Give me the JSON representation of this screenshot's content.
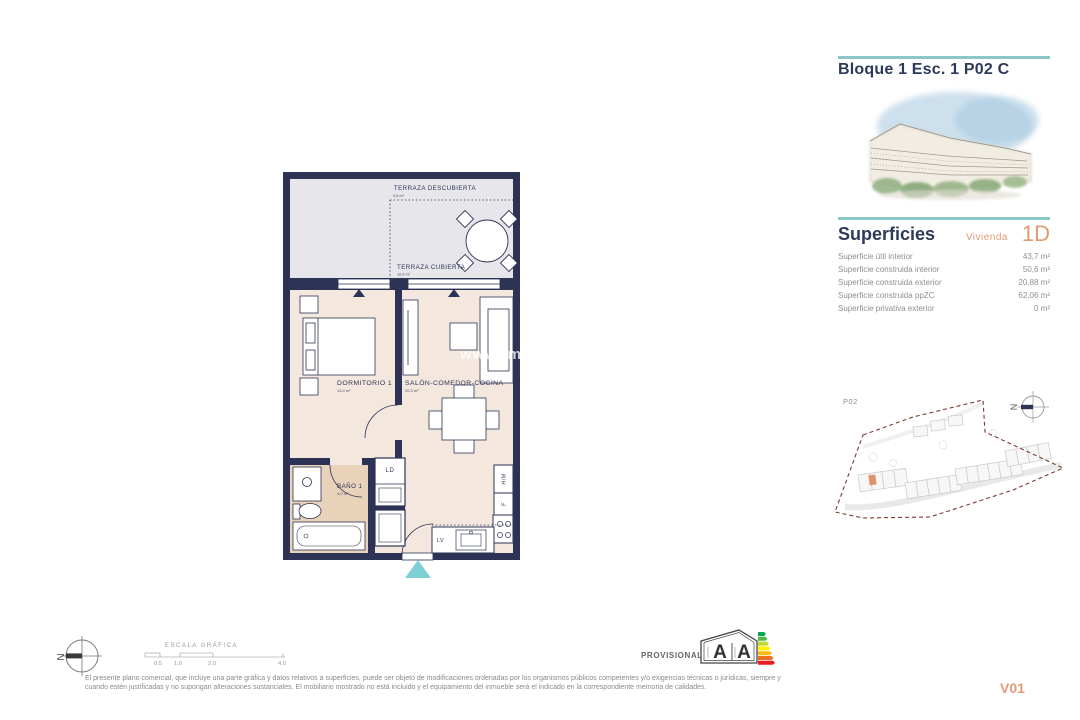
{
  "header": {
    "title": "Bloque 1 Esc. 1 P02 C"
  },
  "superficies": {
    "title": "Superficies",
    "unit_label": "Vivienda",
    "unit_value": "1D",
    "rows": [
      {
        "label": "Superficie útil interior",
        "value": "43,7 m²"
      },
      {
        "label": "Superficie construida interior",
        "value": "50,6 m²"
      },
      {
        "label": "Superficie construida exterior",
        "value": "20,88 m²"
      },
      {
        "label": "Superficie construida ppZC",
        "value": "62,06 m²"
      },
      {
        "label": "Superficie privativa exterior",
        "value": "0 m²"
      }
    ]
  },
  "site_plan": {
    "floor_label": "P02",
    "north_label": "N"
  },
  "floor_plan": {
    "watermark": "www.im",
    "terraza_descubierta": {
      "label": "TERRAZA DESCUBIERTA",
      "area": "9,9 m²"
    },
    "terraza_cubierta": {
      "label": "TERRAZA CUBIERTA",
      "area": "10,9 m²"
    },
    "dormitorio": {
      "label": "DORMITORIO 1",
      "area": "13,4 m²"
    },
    "salon": {
      "label": "SALÓN-COMEDOR-COCINA",
      "area": "20,3 m²"
    },
    "bano": {
      "label": "BAÑO 1",
      "area": "4,0 m²"
    },
    "ld_label": "LD",
    "hm_label": "H/M",
    "f_label": "F",
    "lv_label": "LV"
  },
  "footer": {
    "north_label": "N",
    "scale_title": "ESCALA GRÁFICA",
    "scale_ticks": [
      "0.5",
      "1.0",
      "2.0",
      "4.0"
    ],
    "provisional_label": "PROVISIONAL",
    "energy_letter_left": "A",
    "energy_letter_right": "A",
    "disclaimer_line1": "El presente plano comercial, que incluye una parte gráfica y datos relativos a superficies, puede ser objeto de modificaciones ordenadas por los organismos públicos competentes y/o exigencias técnicas o jurídicas, siempre y",
    "disclaimer_line2": "cuando estén justificadas y no supongan alteraciones sustanciales. El mobiliario mostrado no está incluido y el equipamiento del inmueble será el indicado en la correspondiente memoria de calidades.",
    "version": "V01"
  },
  "colors": {
    "navy": "#2d3354",
    "teal_rule": "#8cc6c7",
    "entry_teal": "#7ed0d4",
    "orange": "#e09a74",
    "floor_interior": "#f4e8de",
    "floor_terrace": "#e6e6eb",
    "floor_bath": "#e8d2ba",
    "site_boundary": "#7a3b30"
  }
}
